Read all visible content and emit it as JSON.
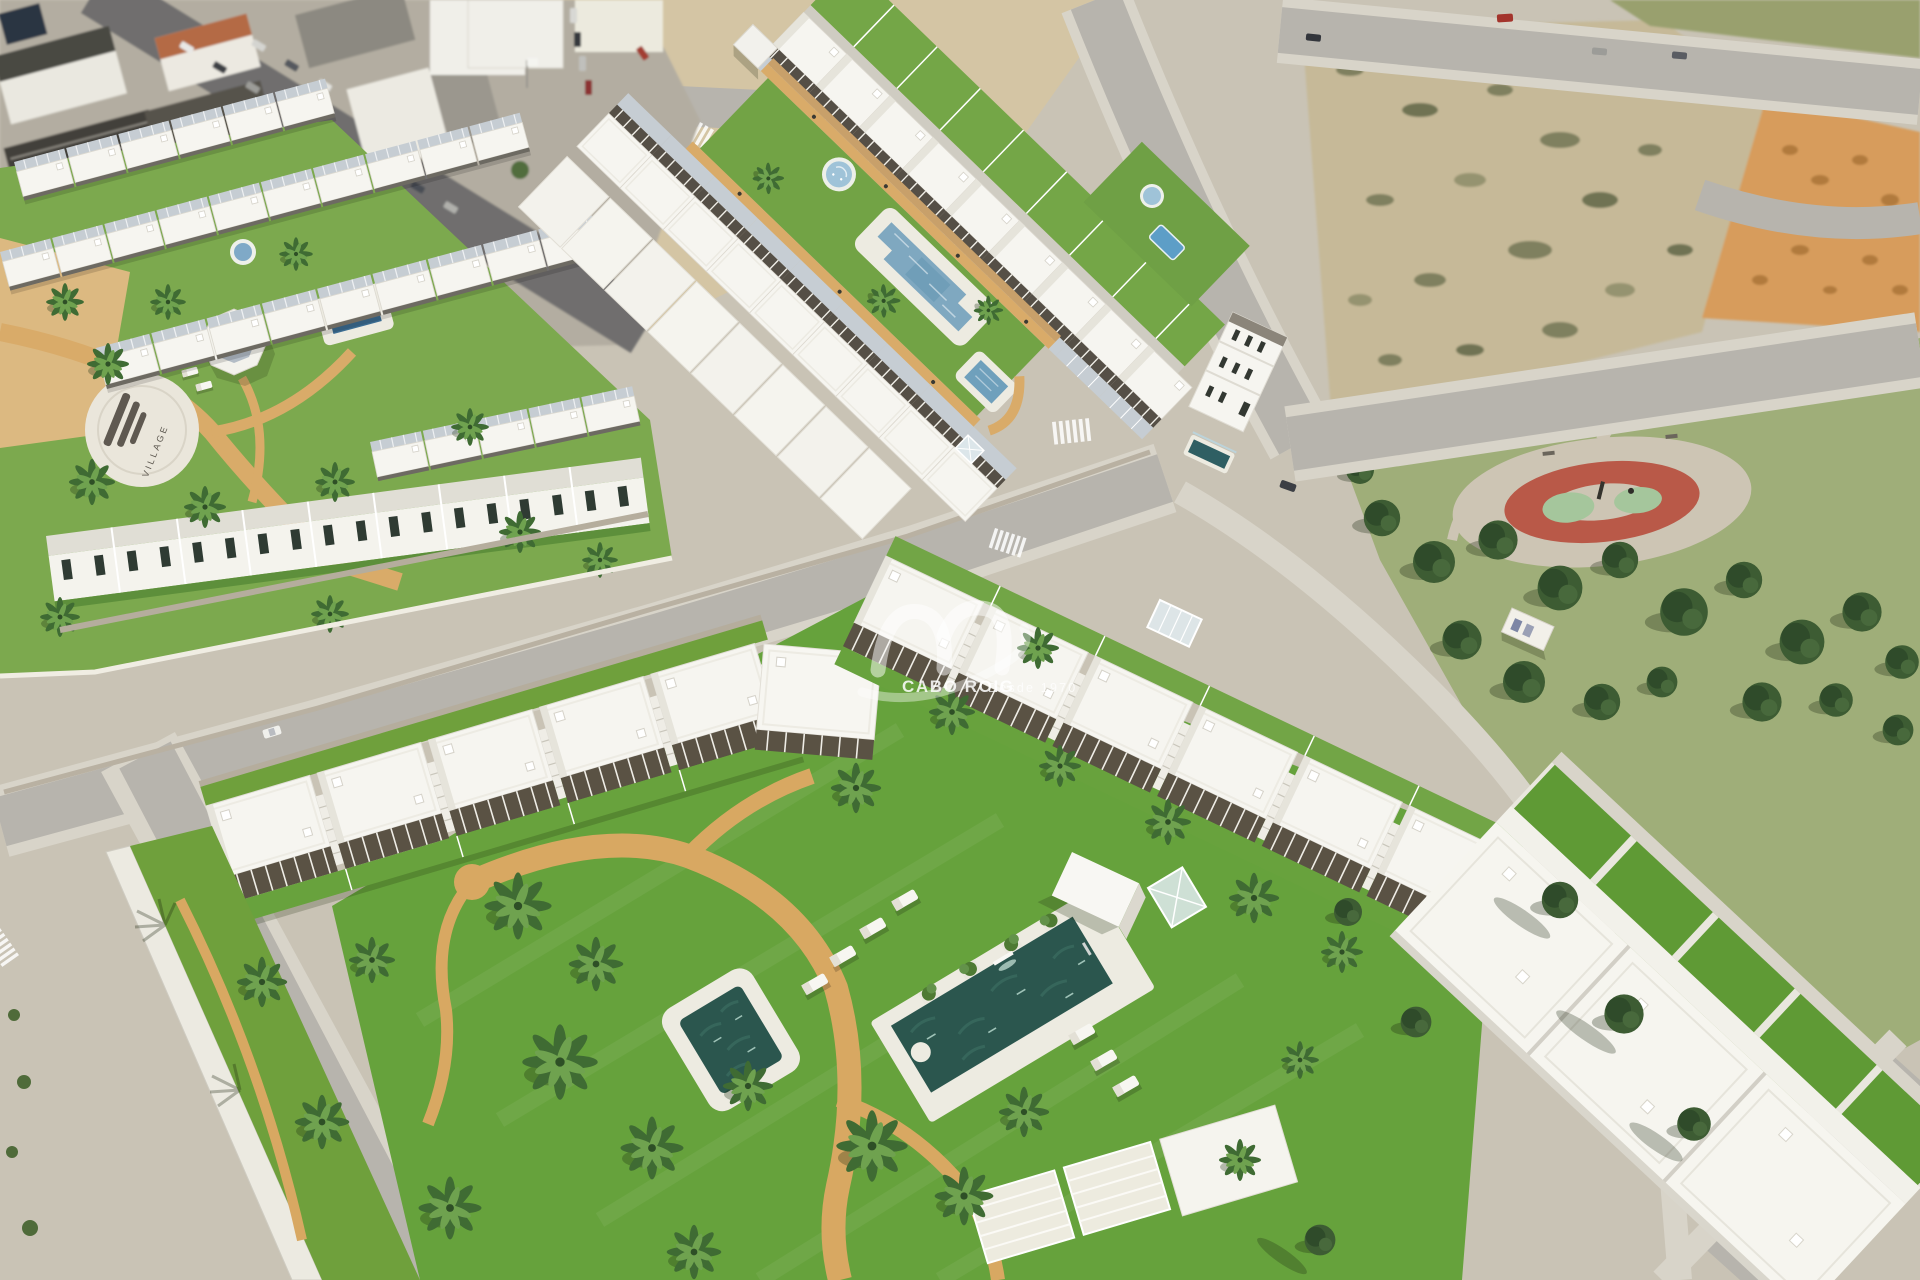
{
  "watermark": {
    "brand": "CABO ROIG",
    "tagline": "Desde 1970"
  },
  "plaza": {
    "ground_text": "VILLAGE"
  },
  "palette": {
    "ground": "#c9c3b5",
    "asphalt": "#b7b4ad",
    "asphalt_dark": "#6f6e6e",
    "sidewalk": "#d8d4c9",
    "town_base": "#b3ada1",
    "town_roof_dark": "#474540",
    "town_roof_brown": "#b46a44",
    "dirt": "#d4c5a4",
    "scrub": "#c6b998",
    "scrub_dot": "#6e7350",
    "dirt_orange": "#d79c5c",
    "dirt_orange_dark": "#b17a3e",
    "lawn": "#7ca94e",
    "lawn_bright": "#72a345",
    "lawn_deep": "#66a23c",
    "park_grass": "#9fae79",
    "sand": "#d9ab69",
    "sand_deep": "#c8a06a",
    "pool_deck": "#edebe1",
    "pool_teal": "#2b564e",
    "pool_blue": "#7fa8c0",
    "pool_splash": "#9fc3d8",
    "white_wall": "#f6f5f0",
    "white_roof": "#f6f5f0",
    "roof_shade": "#e6e4db",
    "terrace_gray": "#c6cdd3",
    "pergola_dark": "#554f46",
    "pergola_bronze": "#5a5244",
    "stone_wall": "#b5ad9d",
    "play_red": "#b95948",
    "play_mint": "#a5c69c",
    "play_pad": "#cdc5b4",
    "tree_dark": "#3d5c33",
    "tree_mid": "#2f4b2a",
    "palm_dark": "#3f6b33",
    "palm_light": "#6fa24f",
    "watermark": "#ffffff"
  }
}
